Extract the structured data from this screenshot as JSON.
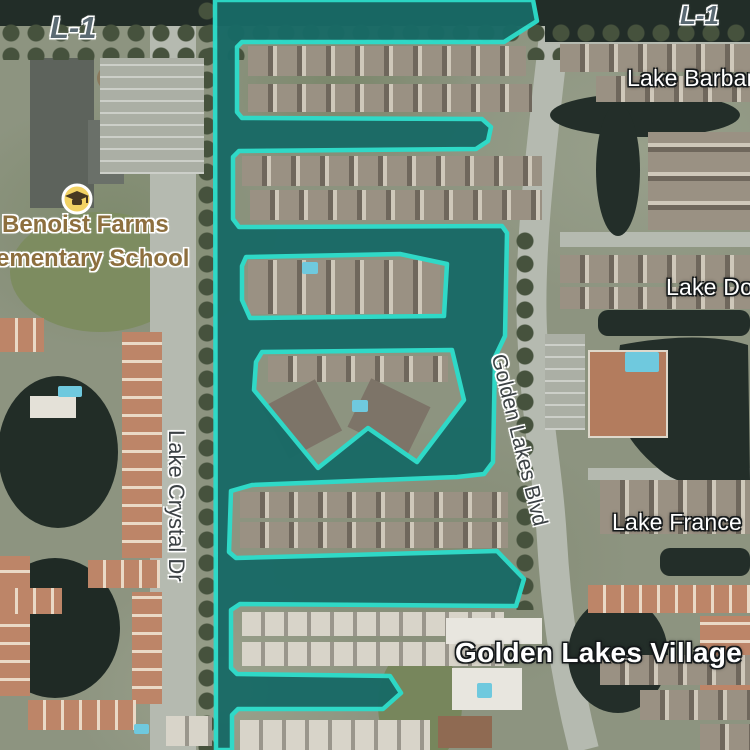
{
  "app": {
    "type": "satellite-map-view"
  },
  "highlight": {
    "feature": "selected-lake-system",
    "fill": "#186a66",
    "stroke": "#2cdcca",
    "stroke_width": 4.5
  },
  "labels": {
    "l1_left": "L-1",
    "l1_right": "L-1",
    "school_line1": "Benoist Farms",
    "school_line2": "ementary School",
    "lake_barbara": "Lake Barbara",
    "lake_do": "Lake Do",
    "lake_france": "Lake France",
    "lake_crystal_dr": "Lake Crystal Dr",
    "golden_lakes_blvd": "Golden Lakes Blvd",
    "golden_lakes_village": "Golden Lakes Village"
  },
  "icons": {
    "school": "graduation-cap"
  },
  "colors": {
    "highlight_fill": "#186a66",
    "highlight_stroke": "#2cdcca",
    "natural_water": "#232e29",
    "road": "#b5bab0",
    "land": "#8d9480",
    "trees": "#46523d",
    "school_label": "#8d6f3e",
    "road_label": "#3c4245",
    "water_label": "#ffffff",
    "canal_label": "#5b6a73",
    "school_icon_bg": "#f2d264",
    "terracotta_roof": "#bd8568",
    "pool": "#6fc9de"
  }
}
